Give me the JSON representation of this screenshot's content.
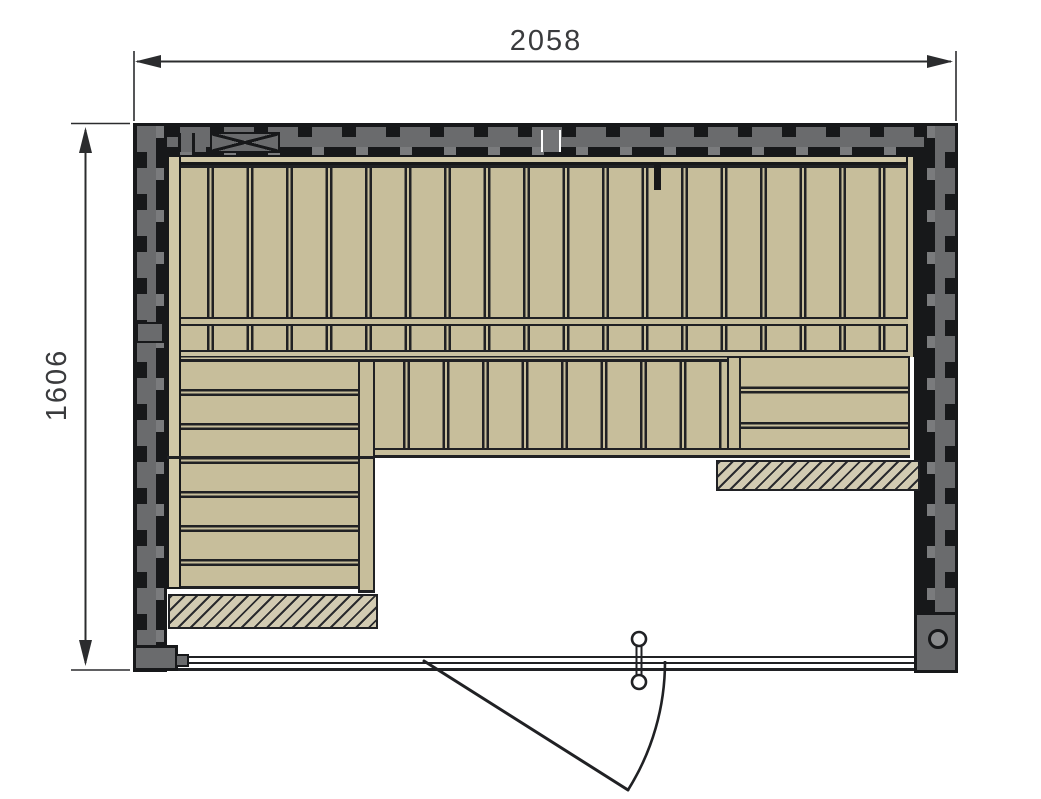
{
  "drawing": {
    "type": "sauna-floor-plan",
    "width_dimension": "2058",
    "height_dimension": "1606",
    "colors": {
      "background": "#ffffff",
      "wall-gray": "#6a6b6d",
      "wall-gray-light": "#7a7b7d",
      "wall-dark": "#17181a",
      "bench-tan": "#c7be9b",
      "backrest-tan": "#d0c7a6",
      "bench-rail-tan": "#cbc2a1",
      "hatch-fill": "#d2cbb2",
      "line-dark": "#202124",
      "dim-color": "#2b2c2e",
      "dim-text": "#3a3b3d"
    }
  }
}
